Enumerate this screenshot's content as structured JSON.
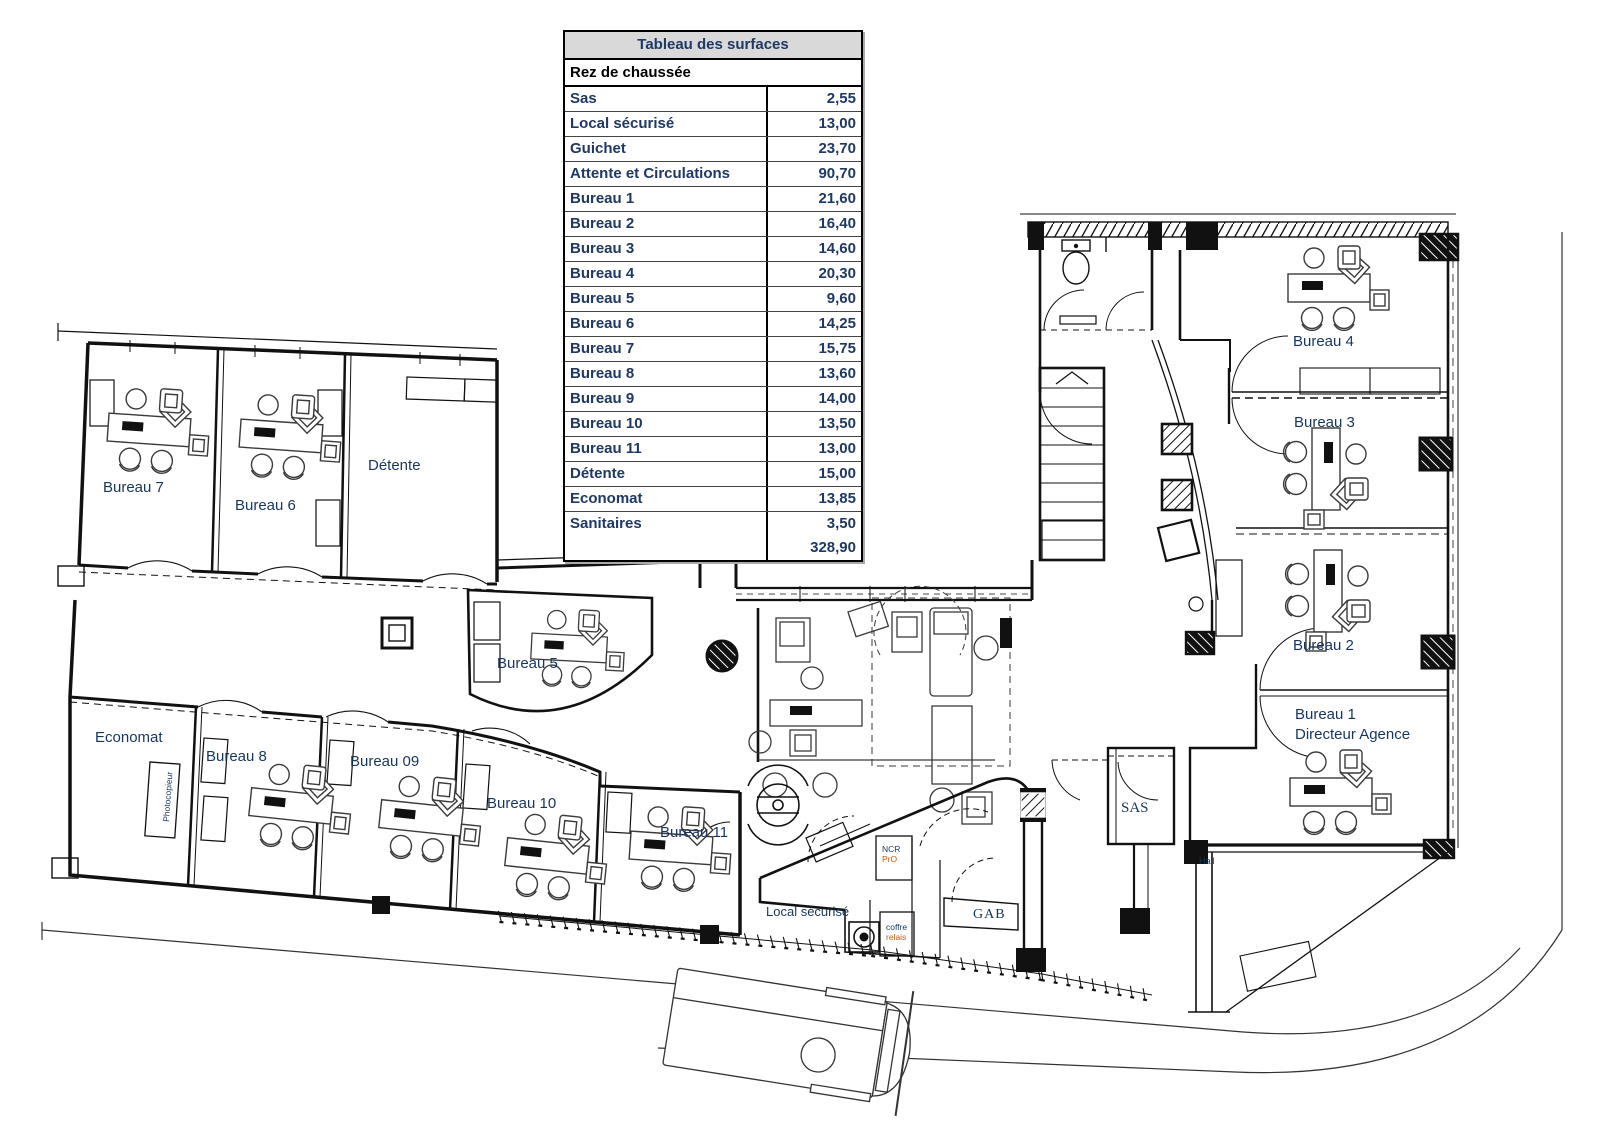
{
  "table": {
    "title": "Tableau des surfaces",
    "section": "Rez de chaussée",
    "rows": [
      {
        "label": "Sas",
        "value": "2,55"
      },
      {
        "label": "Local sécurisé",
        "value": "13,00"
      },
      {
        "label": "Guichet",
        "value": "23,70"
      },
      {
        "label": "Attente et Circulations",
        "value": "90,70"
      },
      {
        "label": "Bureau 1",
        "value": "21,60"
      },
      {
        "label": "Bureau 2",
        "value": "16,40"
      },
      {
        "label": "Bureau 3",
        "value": "14,60"
      },
      {
        "label": "Bureau 4",
        "value": "20,30"
      },
      {
        "label": "Bureau 5",
        "value": "9,60"
      },
      {
        "label": "Bureau 6",
        "value": "14,25"
      },
      {
        "label": "Bureau 7",
        "value": "15,75"
      },
      {
        "label": "Bureau 8",
        "value": "13,60"
      },
      {
        "label": "Bureau 9",
        "value": "14,00"
      },
      {
        "label": "Bureau 10",
        "value": "13,50"
      },
      {
        "label": "Bureau 11",
        "value": "13,00"
      },
      {
        "label": "Détente",
        "value": "15,00"
      },
      {
        "label": "Economat",
        "value": "13,85"
      },
      {
        "label": "Sanitaires",
        "value": "3,50"
      }
    ],
    "total": "328,90"
  },
  "plan": {
    "rooms": {
      "bureau7": "Bureau 7",
      "bureau6": "Bureau 6",
      "detente": "Détente",
      "economat": "Economat",
      "bureau8": "Bureau 8",
      "bureau09": "Bureau 09",
      "bureau10": "Bureau 10",
      "bureau11": "Bureau 11",
      "bureau5": "Bureau 5",
      "bureau4": "Bureau 4",
      "bureau3": "Bureau 3",
      "bureau2": "Bureau 2",
      "bureau1_line1": "Bureau 1",
      "bureau1_line2": "Directeur Agence",
      "sas": "SAS",
      "gab": "GAB",
      "hall": "Hall",
      "local_securise": "Local sécurisé",
      "photocopieur": "Photocopieur",
      "ncr_line1": "NCR",
      "ncr_line2": "PrO",
      "coffre_line1": "coffre",
      "coffre_line2": "relais"
    },
    "colors": {
      "label": "#17365D",
      "accent": "#C55A11"
    }
  }
}
